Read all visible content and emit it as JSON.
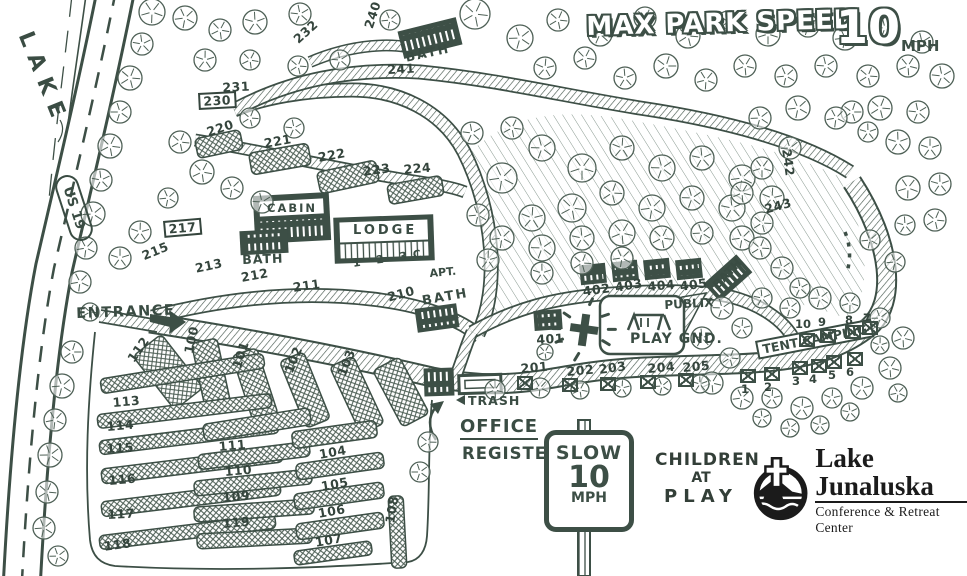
{
  "colors": {
    "ink": "#3d4f46",
    "ink_light": "#52655b",
    "logo_black": "#1b1b1b",
    "paper": "#ffffff"
  },
  "header": {
    "title": "MAX PARK SPEED",
    "speed": "10",
    "unit": "MPH"
  },
  "lake": {
    "label": "LAKE"
  },
  "highway": {
    "label": "US 19"
  },
  "entrance": {
    "label": "ENTRANCE"
  },
  "office": {
    "office": "OFFICE",
    "register": "REGISTER",
    "trash": "TRASH"
  },
  "speed_sign": {
    "line1": "SLOW",
    "line2": "10",
    "line3": "MPH"
  },
  "caution": {
    "line1": "CHILDREN",
    "line2": "AT",
    "line3": "PLAY"
  },
  "logo": {
    "name": "Lake Junaluska",
    "tagline": "Conference & Retreat Center"
  },
  "playground": {
    "name": "PLAY GND.",
    "annex": "PUBLIX"
  },
  "lodge": {
    "label": "LODGE",
    "units": "1 2 3C",
    "apt": "APT."
  },
  "cabin": {
    "label": "CABIN"
  },
  "bath_label": "BATH",
  "tent_camping": {
    "label": "TENT CAMPING",
    "sites": [
      {
        "n": "10",
        "nx": 795,
        "ny": 317,
        "bx": 799,
        "by": 333
      },
      {
        "n": "9",
        "nx": 818,
        "ny": 315,
        "bx": 820,
        "by": 329
      },
      {
        "n": "8",
        "nx": 845,
        "ny": 313,
        "bx": 845,
        "by": 325
      },
      {
        "n": "7",
        "nx": 863,
        "ny": 311,
        "bx": 862,
        "by": 321
      },
      {
        "n": "1",
        "nx": 741,
        "ny": 382,
        "bx": 740,
        "by": 369
      },
      {
        "n": "2",
        "nx": 764,
        "ny": 380,
        "bx": 764,
        "by": 367
      },
      {
        "n": "3",
        "nx": 792,
        "ny": 374,
        "bx": 792,
        "by": 361
      },
      {
        "n": "4",
        "nx": 809,
        "ny": 372,
        "bx": 811,
        "by": 359
      },
      {
        "n": "5",
        "nx": 828,
        "ny": 368,
        "bx": 826,
        "by": 355
      },
      {
        "n": "6",
        "nx": 846,
        "ny": 365,
        "bx": 847,
        "by": 352
      }
    ]
  },
  "road_markers": [
    {
      "x": 517,
      "y": 376
    },
    {
      "x": 562,
      "y": 378
    },
    {
      "x": 600,
      "y": 377
    },
    {
      "x": 640,
      "y": 375
    },
    {
      "x": 678,
      "y": 373
    }
  ],
  "campsites": [
    {
      "n": "100",
      "x": 182,
      "y": 352,
      "rot": -78
    },
    {
      "n": "101",
      "x": 230,
      "y": 366,
      "rot": -72
    },
    {
      "n": "102",
      "x": 282,
      "y": 370,
      "rot": -68
    },
    {
      "n": "103",
      "x": 335,
      "y": 373,
      "rot": -68
    },
    {
      "n": "104",
      "x": 318,
      "y": 448,
      "rot": -10
    },
    {
      "n": "105",
      "x": 320,
      "y": 480,
      "rot": -10
    },
    {
      "n": "106",
      "x": 317,
      "y": 507,
      "rot": -10
    },
    {
      "n": "107",
      "x": 314,
      "y": 536,
      "rot": -10
    },
    {
      "n": "108",
      "x": 383,
      "y": 522,
      "rot": -80
    },
    {
      "n": "109",
      "x": 222,
      "y": 491,
      "rot": -5
    },
    {
      "n": "110",
      "x": 224,
      "y": 465,
      "rot": -5
    },
    {
      "n": "111",
      "x": 218,
      "y": 440,
      "rot": -5
    },
    {
      "n": "112",
      "x": 125,
      "y": 357,
      "rot": -55
    },
    {
      "n": "113",
      "x": 112,
      "y": 396,
      "rot": -5
    },
    {
      "n": "114",
      "x": 106,
      "y": 420,
      "rot": -5
    },
    {
      "n": "115",
      "x": 106,
      "y": 442,
      "rot": -3
    },
    {
      "n": "116",
      "x": 108,
      "y": 474,
      "rot": -5
    },
    {
      "n": "117",
      "x": 107,
      "y": 508,
      "rot": -3
    },
    {
      "n": "118",
      "x": 103,
      "y": 540,
      "rot": -8
    },
    {
      "n": "119",
      "x": 222,
      "y": 517,
      "rot": -5
    },
    {
      "n": "201",
      "x": 520,
      "y": 362,
      "rot": -5
    },
    {
      "n": "202",
      "x": 566,
      "y": 365,
      "rot": -5
    },
    {
      "n": "203",
      "x": 598,
      "y": 363,
      "rot": -8
    },
    {
      "n": "204",
      "x": 647,
      "y": 362,
      "rot": -5
    },
    {
      "n": "205",
      "x": 682,
      "y": 361,
      "rot": -5
    },
    {
      "n": "210",
      "x": 386,
      "y": 291,
      "rot": -15
    },
    {
      "n": "211",
      "x": 292,
      "y": 281,
      "rot": -8
    },
    {
      "n": "212",
      "x": 240,
      "y": 271,
      "rot": -10
    },
    {
      "n": "213",
      "x": 194,
      "y": 262,
      "rot": -12
    },
    {
      "n": "215",
      "x": 140,
      "y": 250,
      "rot": -22
    },
    {
      "n": "217",
      "x": 163,
      "y": 221,
      "rot": -5,
      "boxed": true
    },
    {
      "n": "220",
      "x": 205,
      "y": 126,
      "rot": -18
    },
    {
      "n": "221",
      "x": 263,
      "y": 137,
      "rot": -10
    },
    {
      "n": "222",
      "x": 317,
      "y": 151,
      "rot": -10
    },
    {
      "n": "223",
      "x": 362,
      "y": 165,
      "rot": -8
    },
    {
      "n": "224",
      "x": 403,
      "y": 163,
      "rot": -5
    },
    {
      "n": "230",
      "x": 198,
      "y": 93,
      "rot": -3,
      "boxed": true
    },
    {
      "n": "231",
      "x": 222,
      "y": 81,
      "rot": -3
    },
    {
      "n": "232",
      "x": 291,
      "y": 36,
      "rot": -42
    },
    {
      "n": "240",
      "x": 362,
      "y": 26,
      "rot": -72
    },
    {
      "n": "241",
      "x": 387,
      "y": 63,
      "rot": -3
    },
    {
      "n": "242",
      "x": 793,
      "y": 148,
      "rot": 82
    },
    {
      "n": "243",
      "x": 763,
      "y": 203,
      "rot": -15
    },
    {
      "n": "401",
      "x": 536,
      "y": 333,
      "rot": -3
    },
    {
      "n": "402",
      "x": 582,
      "y": 285,
      "rot": -8
    },
    {
      "n": "403",
      "x": 614,
      "y": 281,
      "rot": -10
    },
    {
      "n": "404",
      "x": 647,
      "y": 280,
      "rot": -5
    },
    {
      "n": "405",
      "x": 679,
      "y": 280,
      "rot": -8
    }
  ]
}
